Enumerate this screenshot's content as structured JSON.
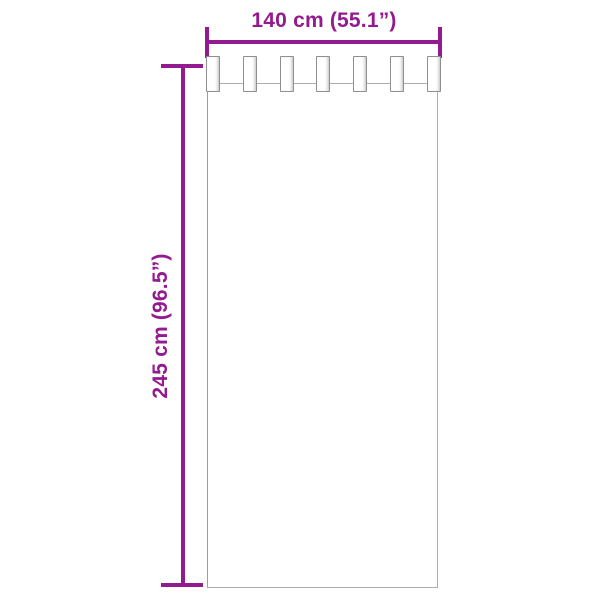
{
  "diagram": {
    "type": "product-dimension-diagram",
    "product": "tab-top curtain panel",
    "background_color": "#ffffff",
    "accent_color": "#931a8f",
    "panel_outline_color": "#aeaeae",
    "tab_outline_color": "#8f8f8f",
    "width_label": "140 cm (55.1”)",
    "height_label": "245 cm (96.5”)",
    "tab_count": 7
  }
}
